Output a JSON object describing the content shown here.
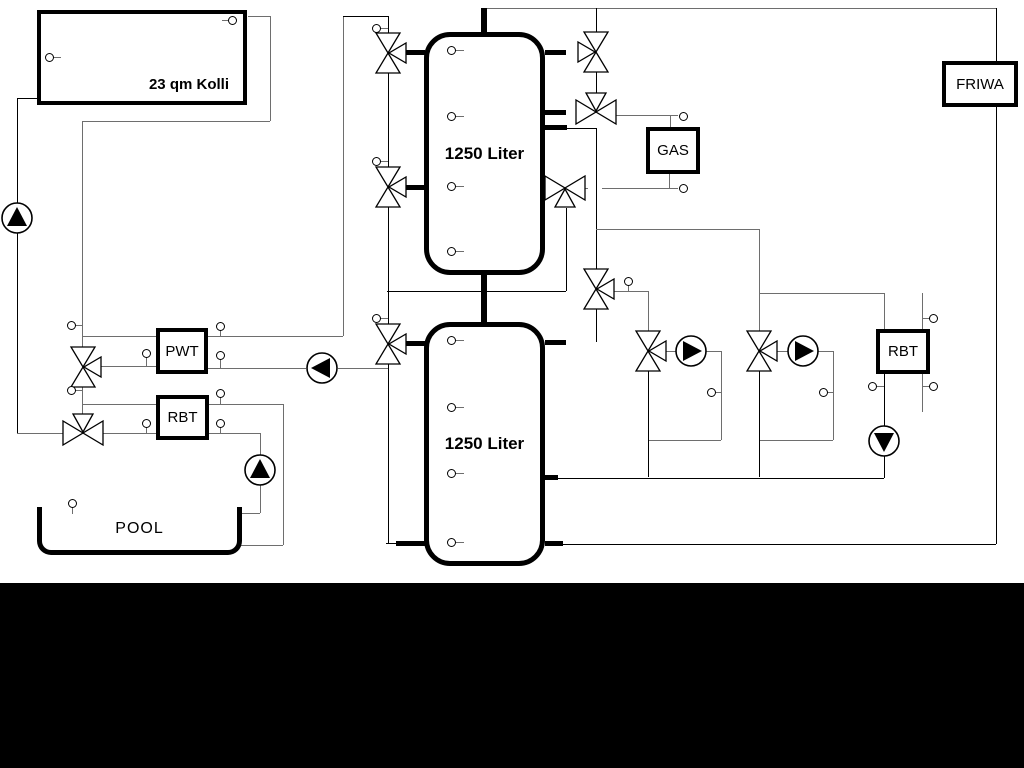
{
  "diagram": {
    "title": "Hydraulic heating scheme with solar collector, buffer tanks, gas boiler, pool and fresh water station",
    "collector": {
      "label": "23 qm Kolli"
    },
    "tank_top": {
      "label": "1250 Liter"
    },
    "tank_bottom": {
      "label": "1250 Liter"
    },
    "gas_boiler": {
      "label": "GAS"
    },
    "friwa": {
      "label": "FRIWA"
    },
    "pwt": {
      "label": "PWT"
    },
    "rbt_pool": {
      "label": "RBT"
    },
    "rbt_heating": {
      "label": "RBT"
    },
    "pool": {
      "label": "POOL"
    }
  },
  "colors": {
    "background": "#ffffff",
    "pipe_gray": "#6e6e6e",
    "pipe_black": "#000000",
    "bottom_bar": "#000000",
    "component_fill": "#ffffff"
  },
  "components": {
    "pumps": [
      {
        "name": "solar-pump",
        "direction": "up"
      },
      {
        "name": "pwt-charge-pump",
        "direction": "left"
      },
      {
        "name": "pool-pump",
        "direction": "up"
      },
      {
        "name": "heating-circuit-pump-1",
        "direction": "right"
      },
      {
        "name": "heating-circuit-pump-2",
        "direction": "right"
      },
      {
        "name": "rbt-return-pump",
        "direction": "down"
      }
    ],
    "three_way_valves": 11,
    "temperature_sensors": 30
  }
}
